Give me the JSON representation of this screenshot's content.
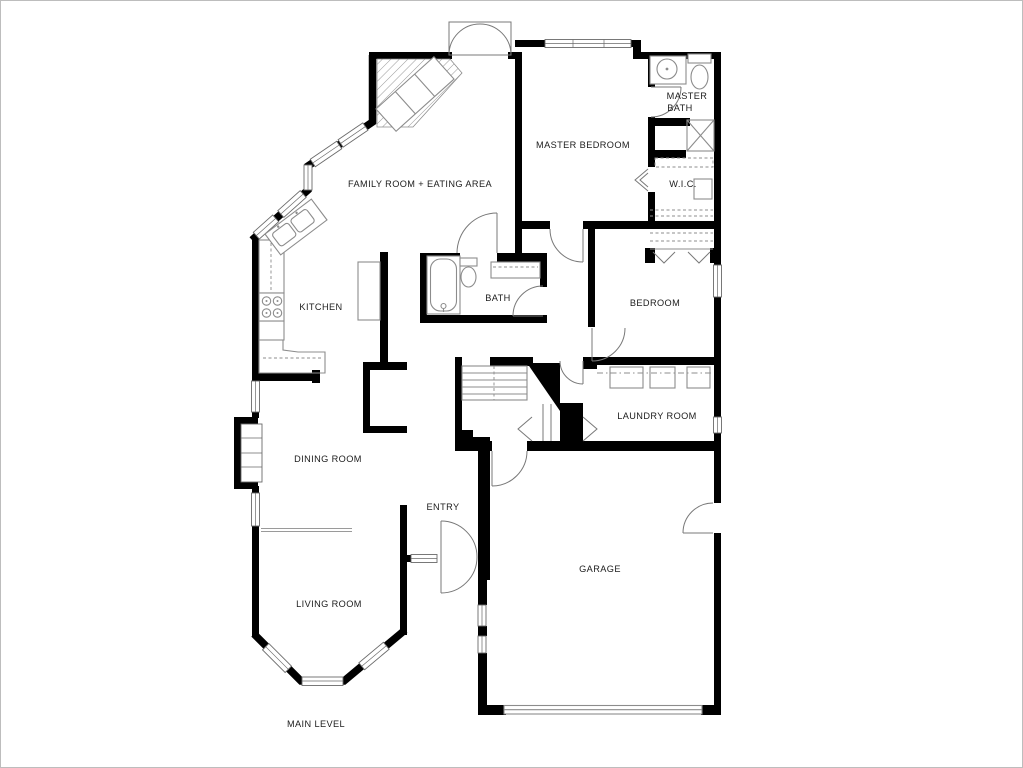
{
  "colors": {
    "wall": "#000000",
    "fixture": "#8c8c8c",
    "text": "#1c1c1c",
    "background": "#ffffff",
    "border": "#bdbdbd"
  },
  "rooms": {
    "family_room": {
      "label": "FAMILY ROOM + EATING AREA"
    },
    "master_bedroom": {
      "label": "MASTER BEDROOM"
    },
    "master_bath": {
      "line1": "MASTER",
      "line2": "BATH"
    },
    "wic": {
      "label": "W.I.C."
    },
    "kitchen": {
      "label": "KITCHEN"
    },
    "bath": {
      "label": "BATH"
    },
    "bedroom": {
      "label": "BEDROOM"
    },
    "laundry_room": {
      "label": "LAUNDRY ROOM"
    },
    "dining_room": {
      "label": "DINING ROOM"
    },
    "entry": {
      "label": "ENTRY"
    },
    "living_room": {
      "label": "LIVING ROOM"
    },
    "garage": {
      "label": "GARAGE"
    }
  },
  "footer": {
    "label": "MAIN LEVEL"
  }
}
